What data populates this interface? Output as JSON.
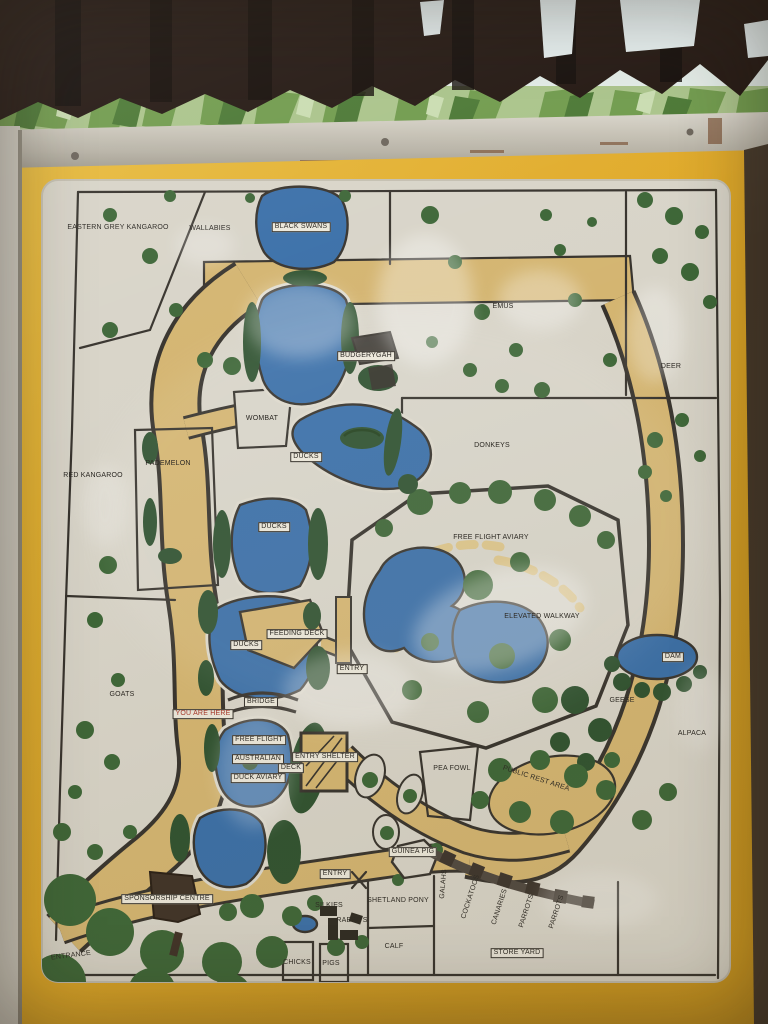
{
  "scene": {
    "description": "Photograph of a yellow-bordered wildlife park map sign under a dark shelter roof with foliage behind",
    "theme": {
      "roof_dark": "#221610",
      "sky_bright": "#e2ebe6",
      "leaf_green": "#6f9a4b",
      "metal_grey": "#c9c4b8",
      "sign_yellow": "#dfa827",
      "sign_yellow_deep": "#c9941c",
      "panel_white": "#d8d4c8",
      "line_dark": "#37332d",
      "path_tan": "#d4b571",
      "walkway_tan_light": "#dcc489",
      "pond_blue": "#3a6fa8",
      "green": "#3d6637",
      "green_dark": "#2f5230",
      "building_brown": "#3f3227",
      "you_are_here_red": "#a63528"
    }
  },
  "map": {
    "labels": [
      {
        "text": "EASTERN GREY KANGAROO",
        "x": 118,
        "y": 228
      },
      {
        "text": "WALLABIES",
        "x": 210,
        "y": 229
      },
      {
        "text": "BLACK SWANS",
        "x": 301,
        "y": 227,
        "boxed": true
      },
      {
        "text": "EMUS",
        "x": 503,
        "y": 307
      },
      {
        "text": "BUDGERYGAH",
        "x": 366,
        "y": 356,
        "boxed": true
      },
      {
        "text": "DEER",
        "x": 671,
        "y": 367
      },
      {
        "text": "WOMBAT",
        "x": 262,
        "y": 419
      },
      {
        "text": "DONKEYS",
        "x": 492,
        "y": 446
      },
      {
        "text": "DUCKS",
        "x": 306,
        "y": 457,
        "boxed": true
      },
      {
        "text": "PADEMELON",
        "x": 168,
        "y": 464
      },
      {
        "text": "RED KANGAROO",
        "x": 93,
        "y": 476
      },
      {
        "text": "DUCKS",
        "x": 274,
        "y": 527,
        "boxed": true
      },
      {
        "text": "FREE FLIGHT AVIARY",
        "x": 491,
        "y": 538
      },
      {
        "text": "ELEVATED WALKWAY",
        "x": 542,
        "y": 617
      },
      {
        "text": "FEEDING DECK",
        "x": 297,
        "y": 634,
        "boxed": true
      },
      {
        "text": "DUCKS",
        "x": 246,
        "y": 645,
        "boxed": true
      },
      {
        "text": "DAM",
        "x": 673,
        "y": 657,
        "boxed": true
      },
      {
        "text": "ENTRY",
        "x": 352,
        "y": 669,
        "boxed": true
      },
      {
        "text": "GOATS",
        "x": 122,
        "y": 695
      },
      {
        "text": "GEESE",
        "x": 622,
        "y": 701
      },
      {
        "text": "BRIDGE",
        "x": 261,
        "y": 702,
        "boxed": true
      },
      {
        "text": "YOU ARE HERE",
        "x": 203,
        "y": 714,
        "boxed": true,
        "color": "#a63528"
      },
      {
        "text": "ALPACA",
        "x": 692,
        "y": 734
      },
      {
        "text": "FREE FLIGHT",
        "x": 259,
        "y": 740,
        "boxed": true
      },
      {
        "text": "ENTRY SHELTER",
        "x": 325,
        "y": 757,
        "boxed": true
      },
      {
        "text": "AUSTRALIAN",
        "x": 258,
        "y": 759,
        "boxed": true
      },
      {
        "text": "DECK",
        "x": 291,
        "y": 768,
        "boxed": true
      },
      {
        "text": "PEA FOWL",
        "x": 452,
        "y": 769
      },
      {
        "text": "DUCK AVIARY",
        "x": 258,
        "y": 778,
        "boxed": true
      },
      {
        "text": "PUBLIC REST AREA",
        "x": 536,
        "y": 779,
        "rotate": 18
      },
      {
        "text": "GUINEA PIG",
        "x": 413,
        "y": 852,
        "boxed": true
      },
      {
        "text": "ENTRY",
        "x": 335,
        "y": 874,
        "boxed": true
      },
      {
        "text": "GALAHS",
        "x": 444,
        "y": 884,
        "rotate": -85
      },
      {
        "text": "COCKATOOS",
        "x": 471,
        "y": 897,
        "rotate": -72
      },
      {
        "text": "SPONSORSHIP CENTRE",
        "x": 167,
        "y": 899,
        "boxed": true
      },
      {
        "text": "SHETLAND PONY",
        "x": 398,
        "y": 901
      },
      {
        "text": "SILKIES",
        "x": 329,
        "y": 906
      },
      {
        "text": "CANARIES",
        "x": 500,
        "y": 907,
        "rotate": -72
      },
      {
        "text": "PARROTS",
        "x": 527,
        "y": 911,
        "rotate": -72
      },
      {
        "text": "PARROTS",
        "x": 557,
        "y": 912,
        "rotate": -72
      },
      {
        "text": "RABBITS",
        "x": 352,
        "y": 921
      },
      {
        "text": "CALF",
        "x": 394,
        "y": 947
      },
      {
        "text": "STORE YARD",
        "x": 517,
        "y": 953,
        "boxed": true
      },
      {
        "text": "ENTRANCE",
        "x": 71,
        "y": 956,
        "rotate": -7
      },
      {
        "text": "CHICKS",
        "x": 297,
        "y": 963
      },
      {
        "text": "PIGS",
        "x": 331,
        "y": 964
      }
    ]
  }
}
